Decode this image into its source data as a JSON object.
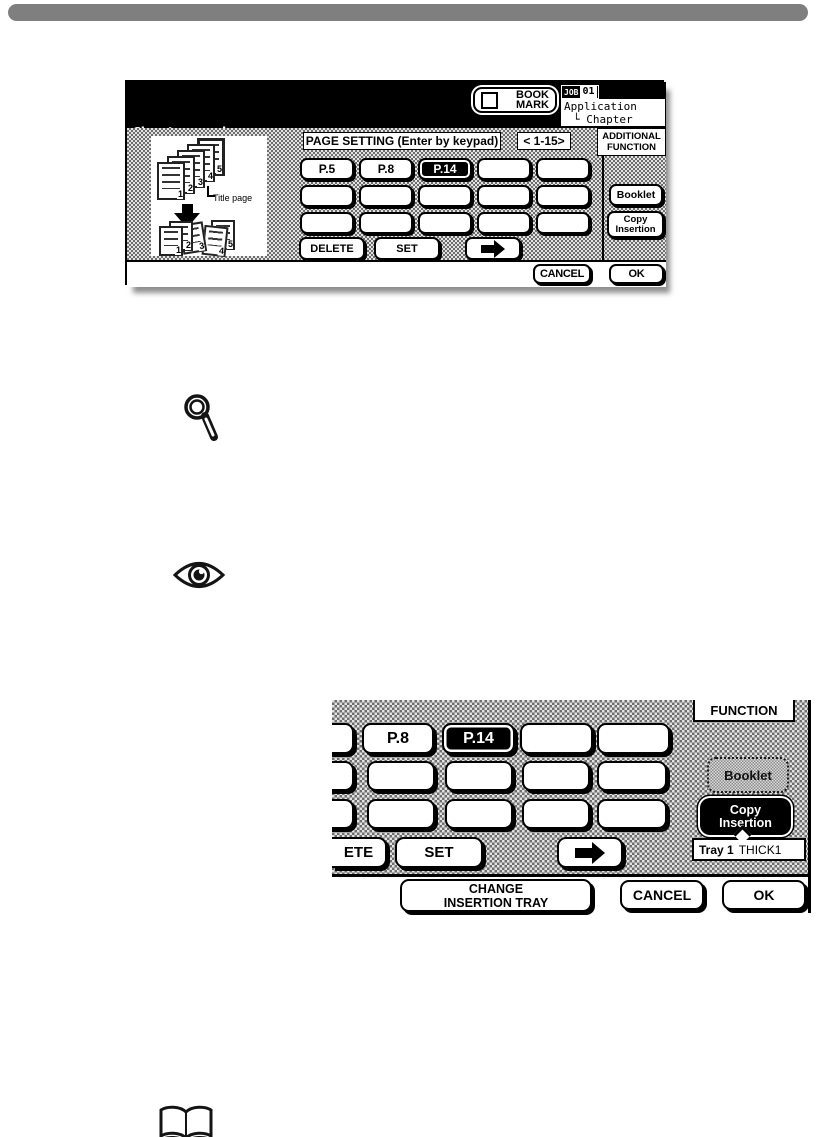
{
  "colors": {
    "top_bar": "#7f7f7f",
    "screen_header_bg": "#000000",
    "dither_dark": "#6d6d6d",
    "dither_light": "#e3e3e3",
    "selected_bg": "#000000",
    "shadow": "#9a9a9a"
  },
  "screen1": {
    "header": {
      "title_line1": "Chapter mode",
      "title_line2": "Enter page number by keypad",
      "bookmark_line1": "BOOK",
      "bookmark_line2": "MARK",
      "job_tab_prefix": "JOB",
      "job_tab_number": "01",
      "job_path_line1": "Application",
      "job_path_line2": "└ Chapter"
    },
    "page_setting_label": "PAGE SETTING (Enter by keypad)",
    "page_range": "< 1-15>",
    "additional_function_line1": "ADDITIONAL",
    "additional_function_line2": "FUNCTION",
    "keypad": {
      "row1": [
        "P.5",
        "P.8",
        "P.14",
        "",
        ""
      ],
      "row2": [
        "",
        "",
        "",
        "",
        ""
      ],
      "row3": [
        "",
        "",
        "",
        "",
        ""
      ],
      "selected_key": "P.14"
    },
    "delete_button": "DELETE",
    "set_button": "SET",
    "booklet_button": "Booklet",
    "copy_insertion_line1": "Copy",
    "copy_insertion_line2": "Insertion",
    "cancel_button": "CANCEL",
    "ok_button": "OK",
    "illustration": {
      "title_page_label": "Title page",
      "top_page_numbers": [
        "1",
        "2",
        "3",
        "4",
        "5"
      ],
      "bottom_page_numbers": [
        "1",
        "2",
        "3",
        "4",
        "5"
      ]
    }
  },
  "screen2": {
    "function_header": "FUNCTION",
    "key_p8": "P.8",
    "key_p14": "P.14",
    "selected_key": "P.14",
    "delete_button_partial": "ETE",
    "set_button": "SET",
    "booklet_button": "Booklet",
    "copy_insertion_line1": "Copy",
    "copy_insertion_line2": "Insertion",
    "tray_name": "Tray 1",
    "tray_type": "THICK1",
    "change_tray_line1": "CHANGE",
    "change_tray_line2": "INSERTION TRAY",
    "cancel_button": "CANCEL",
    "ok_button": "OK"
  },
  "icons": {
    "magnifier": "magnifying-glass",
    "eye": "eye",
    "open_book": "open-book",
    "right_arrow": "right-arrow",
    "down_arrow": "down-arrow",
    "bookmark_checkbox": "checkbox-unchecked",
    "copy_insertion_pointer": "callout-pointer"
  }
}
